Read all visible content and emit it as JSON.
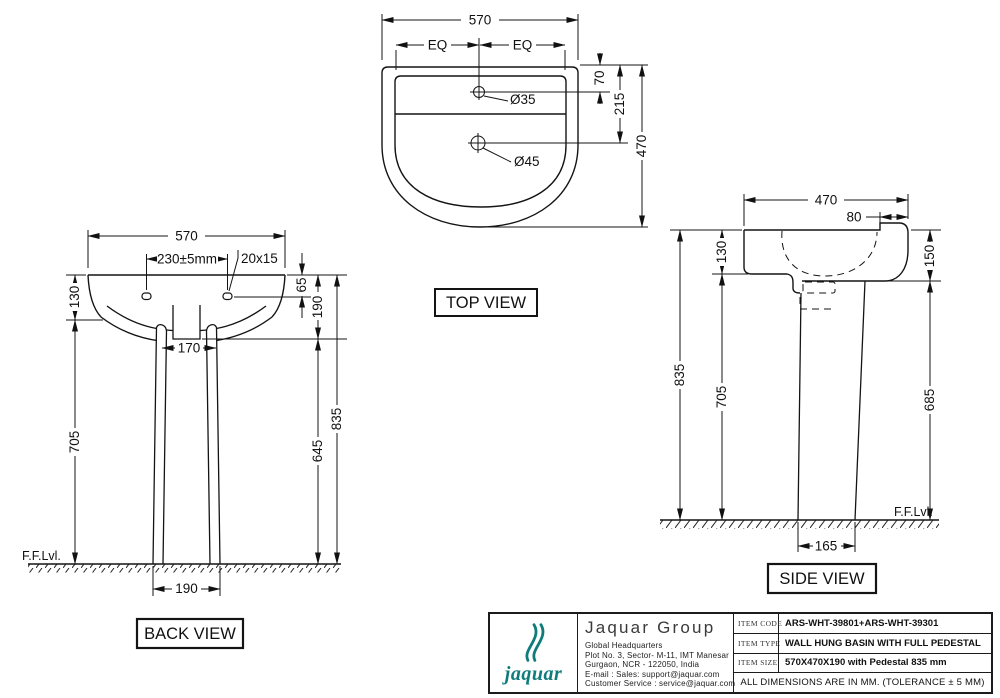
{
  "drawing": {
    "top_view": {
      "label": "TOP VIEW",
      "width": "570",
      "eq_left": "EQ",
      "eq_right": "EQ",
      "faucet_hole": "Ø35",
      "drain_hole": "Ø45",
      "faucet_offset": "70",
      "drain_offset": "215",
      "depth": "470"
    },
    "back_view": {
      "label": "BACK VIEW",
      "width": "570",
      "fixing_hole_centers": "230±5mm",
      "fixing_hole_size": "20x15",
      "rim_drop": "130",
      "fixing_hole_drop": "65",
      "basin_depth": "190",
      "pedestal_inner_width": "170",
      "underside_height": "705",
      "pedestal_height": "645",
      "overall_height": "835",
      "pedestal_base_width": "190",
      "floor_level": "F.F.Lvl."
    },
    "side_view": {
      "label": "SIDE VIEW",
      "depth": "470",
      "front_rim": "80",
      "rim_drop_back": "130",
      "rim_drop_front": "150",
      "overall_height": "835",
      "underside_height": "705",
      "front_underside_height": "685",
      "pedestal_base_depth": "165",
      "floor_level": "F.F.Lvl."
    }
  },
  "title_block": {
    "brand_color": "#0e7c7b",
    "logo_word": "jaquar",
    "company_name": "Jaquar Group",
    "address": [
      "Global Headquarters",
      "Plot No. 3, Sector- M-11, IMT Manesar",
      "Gurgaon, NCR - 122050, India",
      "E-mail : Sales: support@jaquar.com",
      "Customer Service : service@jaquar.com"
    ],
    "rows": [
      {
        "label": "ITEM CODE",
        "value": "ARS-WHT-39801+ARS-WHT-39301"
      },
      {
        "label": "ITEM TYPE",
        "value": "WALL HUNG BASIN WITH FULL PEDESTAL"
      },
      {
        "label": "ITEM SIZE",
        "value": "570X470X190 with Pedestal 835 mm"
      }
    ],
    "note": "ALL DIMENSIONS ARE IN MM. (TOLERANCE ± 5 MM)"
  }
}
